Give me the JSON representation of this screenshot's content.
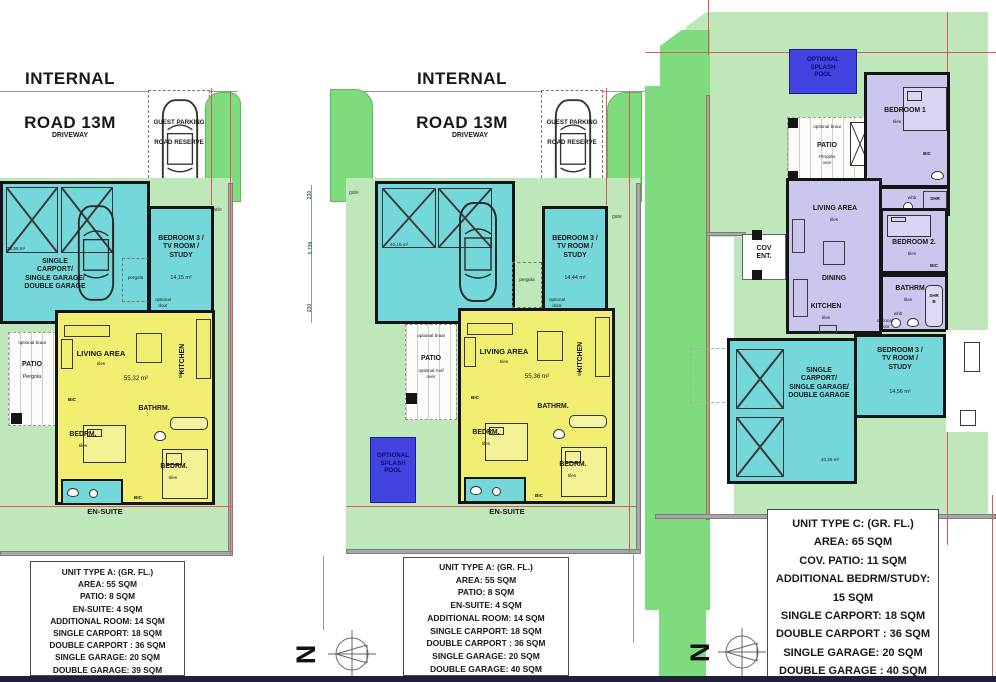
{
  "colors": {
    "site_green": "#bfe8ba",
    "hedge_green": "#7edc7e",
    "room_cyan": "#74d8da",
    "unit_yellow": "#f2ee72",
    "unit_purple": "#c9c7ee",
    "pool_blue": "#4343e2",
    "wall_black": "#141414",
    "boundary_red": "#e05555",
    "boundary_gray": "#a8a8a8"
  },
  "road": {
    "title_line1": "INTERNAL",
    "title_line2": "ROAD  13M",
    "driveway": "DRIVEWAY",
    "guest_parking": "GUEST PARKING",
    "road_reserve": "ROAD RESERVE"
  },
  "compass": {
    "north": "N"
  },
  "left_plan": {
    "garage_area": "38,55 m²",
    "garage_label": "SINGLE\nCARPORT/\nSINGLE GARAGE/\nDOUBLE GARAGE",
    "bedroom3_label": "BEDROOM 3 /\nTV ROOM /\nSTUDY",
    "bedroom3_area": "14,15 m²",
    "pergola": "pergola",
    "optional_door": "optional\ndoor",
    "gate": "gate",
    "living_area": "LIVING AREA",
    "tiles": "tiles",
    "area": "55,32 m²",
    "kitchen": "KITCHEN",
    "bathrm": "BATHRM.",
    "bedrm": "BEDRM.",
    "bic": "BIC",
    "patio": "PATIO",
    "patio_sub": "Pergola",
    "optional_braai": "optional braai",
    "ensuite": "EN-SUITE",
    "specs": [
      "UNIT TYPE A: (GR. FL.)",
      "AREA: 55 SQM",
      "PATIO: 8 SQM",
      "EN-SUITE: 4 SQM",
      "ADDITIONAL ROOM: 14 SQM",
      "SINGLE CARPORT: 18 SQM",
      "DOUBLE CARPORT : 36 SQM",
      "SINGLE GARAGE: 20 SQM",
      "DOUBLE GARAGE: 39 SQM"
    ]
  },
  "middle_plan": {
    "garage_area": "40,15 m²",
    "bedroom3_label": "BEDROOM 3 /\nTV ROOM /\nSTUDY",
    "bedroom3_area": "14,44 m²",
    "pergola": "pergola",
    "optional_door": "optional\ndoor",
    "gate": "gate",
    "living_area": "LIVING AREA",
    "tiles": "tiles",
    "area": "55,36 m²",
    "kitchen": "KITCHEN",
    "bathrm": "BATHRM.",
    "bedrm": "BEDRM.",
    "bic": "BIC",
    "patio": "PATIO",
    "patio_sub": "optional roof\nover",
    "optional_braai": "optional braai",
    "ensuite": "EN-SUITE",
    "pool": "OPTIONAL\nSPLASH\nPOOL",
    "dims": [
      "230",
      "5.739",
      "230"
    ],
    "specs": [
      "UNIT TYPE A: (GR. FL.)",
      "AREA: 55 SQM",
      "PATIO: 8 SQM",
      "EN-SUITE: 4 SQM",
      "ADDITIONAL ROOM: 14 SQM",
      "SINGLE CARPORT: 18 SQM",
      "DOUBLE CARPORT : 36 SQM",
      "SINGLE GARAGE: 20 SQM",
      "DOUBLE GARAGE: 40 SQM"
    ]
  },
  "right_plan": {
    "pool": "OPTIONAL\nSPLASH\nPOOL",
    "patio": "PATIO",
    "patio_sub": "Pergola\nover",
    "optional_braai": "optional braai",
    "bedroom1": "BEDROOM 1",
    "bedroom2": "BEDROOM 2.",
    "bathrm": "BATHRM.",
    "shr": "SHR",
    "shr_b": "SHR\nB",
    "whb": "whb",
    "bic": "BIC",
    "tiles": "tiles",
    "living_area": "LIVING AREA",
    "dining": "DINING",
    "kitchen": "KITCHEN",
    "cov_ent": "COV\nENT.",
    "optional_door": "optional\ndoor",
    "bedroom3_label": "BEDROOM 3 /\nTV ROOM /\nSTUDY",
    "bedroom3_area": "14,56 m²",
    "carport_label": "SINGLE\nCARPORT/\nSINGLE GARAGE/\nDOUBLE GARAGE",
    "carport_area": "40,25 m²",
    "specs": [
      "UNIT TYPE C: (GR. FL.)",
      "AREA: 65 SQM",
      "COV. PATIO: 11 SQM",
      "ADDITIONAL BEDRM/STUDY: 15 SQM",
      "SINGLE CARPORT: 18 SQM",
      "DOUBLE CARPORT : 36 SQM",
      "SINGLE GARAGE: 20 SQM",
      "DOUBLE GARAGE : 40 SQM"
    ]
  }
}
